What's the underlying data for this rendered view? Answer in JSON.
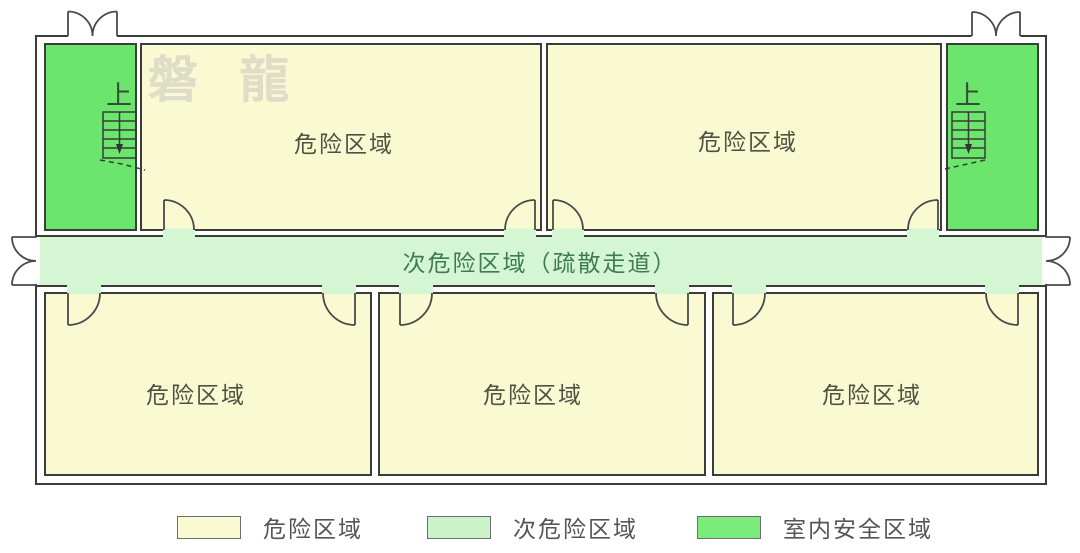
{
  "colors": {
    "hazard_fill": "#FAFAD2",
    "secondary_fill": "#D5F6D3",
    "safe_fill": "#6BE56B",
    "legend_hazard": "#FAFAD2",
    "legend_secondary": "#CBF3C9",
    "legend_safe": "#7BEC7B",
    "wall_stroke": "#3c3c3c",
    "room_label_color": "#4e5243",
    "corridor_label_color": "#3e7c4e",
    "legend_label_color": "#555555"
  },
  "watermark": {
    "text": "磐 龍"
  },
  "rooms": [
    {
      "id": "top-left",
      "label": "危险区域"
    },
    {
      "id": "top-right",
      "label": "危险区域"
    },
    {
      "id": "bottom-left",
      "label": "危险区域"
    },
    {
      "id": "bottom-middle",
      "label": "危险区域"
    },
    {
      "id": "bottom-right",
      "label": "危险区域"
    }
  ],
  "corridor": {
    "label": "次危险区域（疏散走道）"
  },
  "stairwells": {
    "left_label": "上",
    "right_label": "上"
  },
  "legend": {
    "items": [
      {
        "label": "危险区域",
        "color": "#FAFAD2"
      },
      {
        "label": "次危险区域",
        "color": "#CBF3C9"
      },
      {
        "label": "室内安全区域",
        "color": "#7BEC7B"
      }
    ]
  }
}
